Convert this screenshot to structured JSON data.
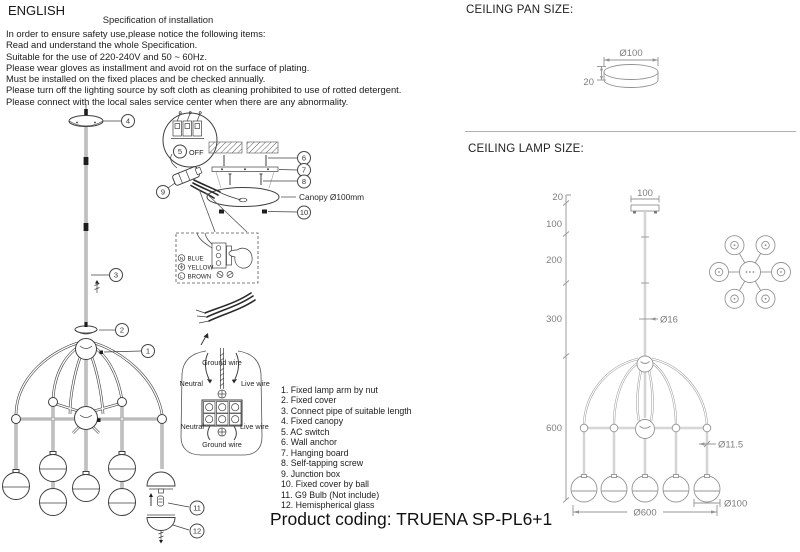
{
  "header": {
    "language": "ENGLISH"
  },
  "spec": {
    "title": "Specification of installation",
    "lines": [
      "In order to ensure safety use,please notice the following items:",
      "Read and understand the whole Specification.",
      "Suitable for the use of 220-240V and 50 ~ 60Hz.",
      "Please wear gloves as installment and avoid rot on the surface of plating.",
      "Must be installed on the fixed places and be checked annually.",
      "Please turn off the lighting source by soft cloth as cleaning prohibited to use of rotted detergent.",
      "Please connect with the local sales service center when there are any abnormality."
    ]
  },
  "parts": {
    "items": [
      "1. Fixed lamp arm by nut",
      "2. Fixed cover",
      "3. Connect pipe of suitable length",
      "4. Fixed canopy",
      "5. AC switch",
      "6. Wall anchor",
      "7. Hanging board",
      "8. Self-tapping screw",
      "9. Junction box",
      "10. Fixed cover by ball",
      "11. G9 Bulb (Not include)",
      "12. Hemispherical glass"
    ]
  },
  "product": {
    "coding": "Product coding: TRUENA SP-PL6+1"
  },
  "install": {
    "off_label": "OFF",
    "canopy_label": "Canopy Ø100mm",
    "wire_box": {
      "n_letter": "N",
      "l_letter": "L",
      "blue": "BLUE",
      "yellow": "YELLOW",
      "brown": "BROWN"
    },
    "terminal": {
      "ground_top": "Ground wire",
      "neutral_top": "Neutral",
      "live_top": "Live wire",
      "neutral_bottom": "Neutral",
      "live_bottom": "Live wire",
      "ground_bottom": "Ground wire"
    },
    "callouts": {
      "c1": "1",
      "c2": "2",
      "c3": "3",
      "c4": "4",
      "c5": "5",
      "c6": "6",
      "c7": "7",
      "c8": "8",
      "c9": "9",
      "c10": "10",
      "c11": "11",
      "c12": "12"
    }
  },
  "pan": {
    "title": "CEILING PAN SIZE:",
    "diameter": "Ø100",
    "height": "20"
  },
  "lamp": {
    "title": "CEILING LAMP SIZE:",
    "height_20": "20",
    "seg_100": "100",
    "seg_200": "200",
    "seg_300": "300",
    "seg_600": "600",
    "canopy_width": "100",
    "rod_diameter": "Ø16",
    "arm_diameter": "Ø11.5",
    "ball_diameter": "Ø100",
    "total_diameter": "Ø600"
  }
}
